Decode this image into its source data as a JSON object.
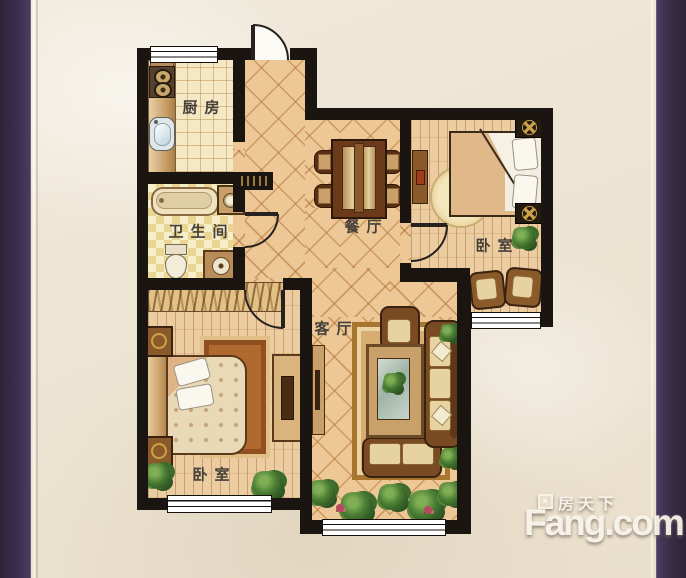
{
  "frame": {
    "left_bar_color": "#372c46",
    "right_bar_color": "#372c46",
    "background_color": "#ece3d1",
    "wall_color": "#1b1511"
  },
  "palette": {
    "diagonal_tile": "#edc795",
    "kitchen_tile": "#f5e8c4",
    "bath_tile": "#f6eec8",
    "wood_floor": "#eccda2",
    "furniture_wood": "#7a4a22",
    "cushion": "#e7d2a2",
    "plant_green": "#3a6b2a"
  },
  "rooms": {
    "kitchen": {
      "label": "厨房"
    },
    "bathroom": {
      "label": "卫生间"
    },
    "dining": {
      "label": "餐厅"
    },
    "living": {
      "label": "客厅"
    },
    "bedroom_right": {
      "label": "卧室"
    },
    "bedroom_left": {
      "label": "卧室"
    }
  },
  "watermark": {
    "brand_cn": "房天下",
    "brand_en": "Fang.com"
  }
}
